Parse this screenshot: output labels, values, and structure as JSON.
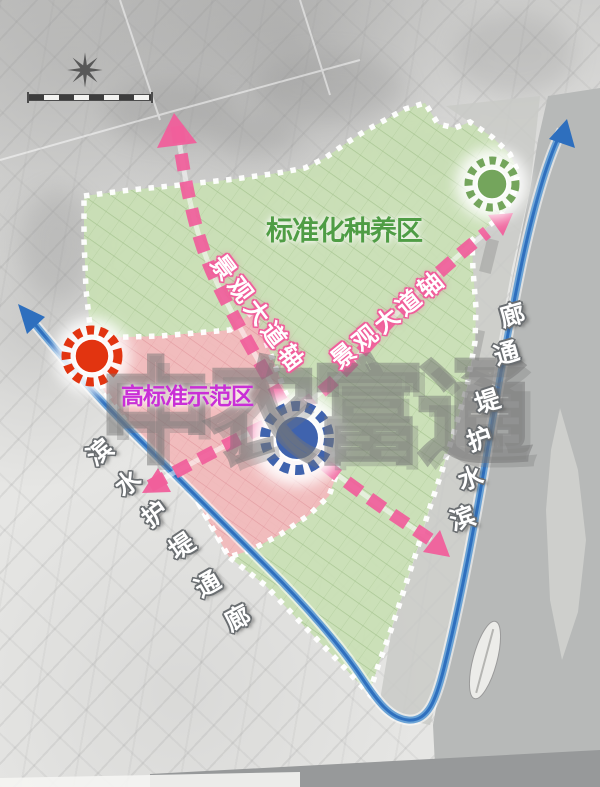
{
  "labels": {
    "green_zone": "标准化种养区",
    "pink_zone": "高标准示范区",
    "axis": "景观大道轴",
    "corridor": "滨水护堤通廊",
    "watermark": "中农富通"
  },
  "icons": {
    "north_arrow": "8-point-compass-star",
    "scale_bar": "segmented-map-scale-bar"
  },
  "colors": {
    "green_zone": "#c9dfb4",
    "green_zone_line": "#9cbd86",
    "pink_zone": "#f2b9bd",
    "pink_zone_line": "#dd8f96",
    "axis_pink": "#f05f9b",
    "corridor_blue": "#2e6fbe",
    "corridor_blue_light": "#6ba3d6",
    "node_red": "#e23410",
    "node_green": "#74a55c",
    "node_blue": "#3f63ae",
    "label_green": "#4f9d45",
    "label_magenta": "#c92fd6",
    "river_gray": "#b7b9b8"
  }
}
